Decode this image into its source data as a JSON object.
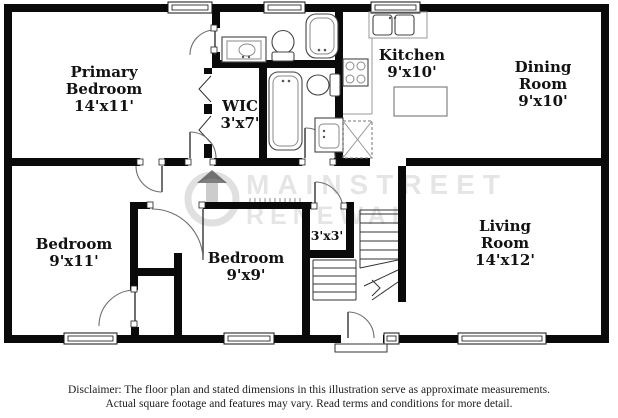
{
  "watermark": {
    "line1": "MAINSTREET",
    "line2": "RENEWAL"
  },
  "rooms": {
    "primary_bedroom": {
      "name": "Primary Bedroom",
      "dims": "14'x11'"
    },
    "wic": {
      "name": "WIC",
      "dims": "3'x7'"
    },
    "kitchen": {
      "name": "Kitchen",
      "dims": "9'x10'"
    },
    "dining_room": {
      "name": "Dining Room",
      "dims": "9'x10'"
    },
    "bedroom_left": {
      "name": "Bedroom",
      "dims": "9'x11'"
    },
    "bedroom_middle": {
      "name": "Bedroom",
      "dims": "9'x9'"
    },
    "hall_closet": {
      "dims": "3'x3'"
    },
    "living_room": {
      "name": "Living Room",
      "dims": "14'x12'"
    }
  },
  "disclaimer": {
    "line1": "Disclaimer: The floor plan and stated dimensions in this illustration serve as approximate measurements.",
    "line2": "Actual square footage and features may vary. Read terms and conditions for more detail."
  },
  "colors": {
    "wall": "#0a0a0a",
    "fixture": "#555555"
  }
}
